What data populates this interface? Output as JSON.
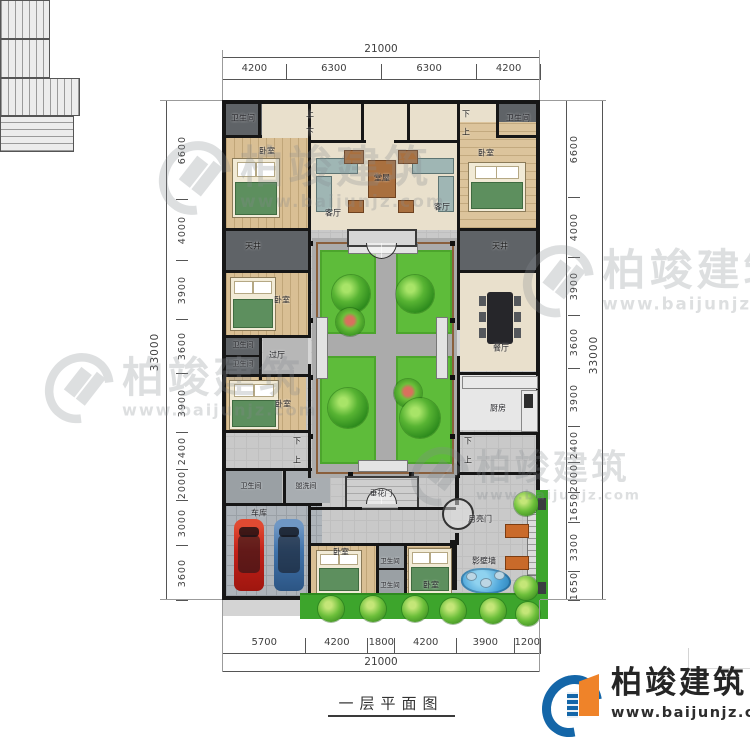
{
  "page_title": "一层平面图",
  "brand": {
    "name": "柏竣建筑",
    "url": "www.baijunjz.com"
  },
  "watermark": {
    "name": "柏竣建筑",
    "url": "www.baijunjz.com"
  },
  "colors": {
    "accent_blue": "#1466a8",
    "accent_orange": "#ef8329",
    "lawn": "#5ebc3a",
    "wall": "#161616"
  },
  "stair_labels": {
    "up": "上",
    "down": "下"
  },
  "dimensions": {
    "top": {
      "total": "21000",
      "segments": [
        "4200",
        "6300",
        "6300",
        "4200"
      ]
    },
    "bottom": {
      "total": "21000",
      "segments": [
        "5700",
        "4200",
        "1800",
        "4200",
        "3900",
        "1200"
      ]
    },
    "left": {
      "total": "33000",
      "segments": [
        "6600",
        "4000",
        "3900",
        "3600",
        "3900",
        "2400",
        "2000",
        "3000",
        "3600"
      ]
    },
    "right": {
      "total": "33000",
      "segments": [
        "6600",
        "4000",
        "3900",
        "3600",
        "3900",
        "2400",
        "2000",
        "1650",
        "3300",
        "1650"
      ]
    }
  },
  "rooms": [
    {
      "id": "wc-top-left",
      "label": "卫生间"
    },
    {
      "id": "bedroom-top-left",
      "label": "卧室"
    },
    {
      "id": "living-left",
      "label": "客厅"
    },
    {
      "id": "main-hall",
      "label": "堂屋"
    },
    {
      "id": "living-right",
      "label": "客厅"
    },
    {
      "id": "bedroom-top-right",
      "label": "卧室"
    },
    {
      "id": "wc-top-right",
      "label": "卫生间"
    },
    {
      "id": "lightwell-left",
      "label": "天井"
    },
    {
      "id": "bedroom-mid-left",
      "label": "卧室"
    },
    {
      "id": "wc-mid-1",
      "label": "卫生间"
    },
    {
      "id": "wc-mid-2",
      "label": "卫生间"
    },
    {
      "id": "vestibule",
      "label": "过厅"
    },
    {
      "id": "lightwell-right",
      "label": "天井"
    },
    {
      "id": "dining",
      "label": "餐厅"
    },
    {
      "id": "bedroom-low-left",
      "label": "卧室"
    },
    {
      "id": "kitchen",
      "label": "厨房"
    },
    {
      "id": "wc-bottom-left",
      "label": "卫生间"
    },
    {
      "id": "washroom",
      "label": "盥洗间"
    },
    {
      "id": "garage",
      "label": "车库"
    },
    {
      "id": "flower-gate",
      "label": "垂花门"
    },
    {
      "id": "moon-gate",
      "label": "月亮门"
    },
    {
      "id": "screen-wall",
      "label": "影壁墙"
    },
    {
      "id": "bedroom-b1",
      "label": "卧室"
    },
    {
      "id": "wc-b1",
      "label": "卫生间"
    },
    {
      "id": "wc-b2",
      "label": "卫生间"
    },
    {
      "id": "bedroom-b2",
      "label": "卧室"
    }
  ]
}
